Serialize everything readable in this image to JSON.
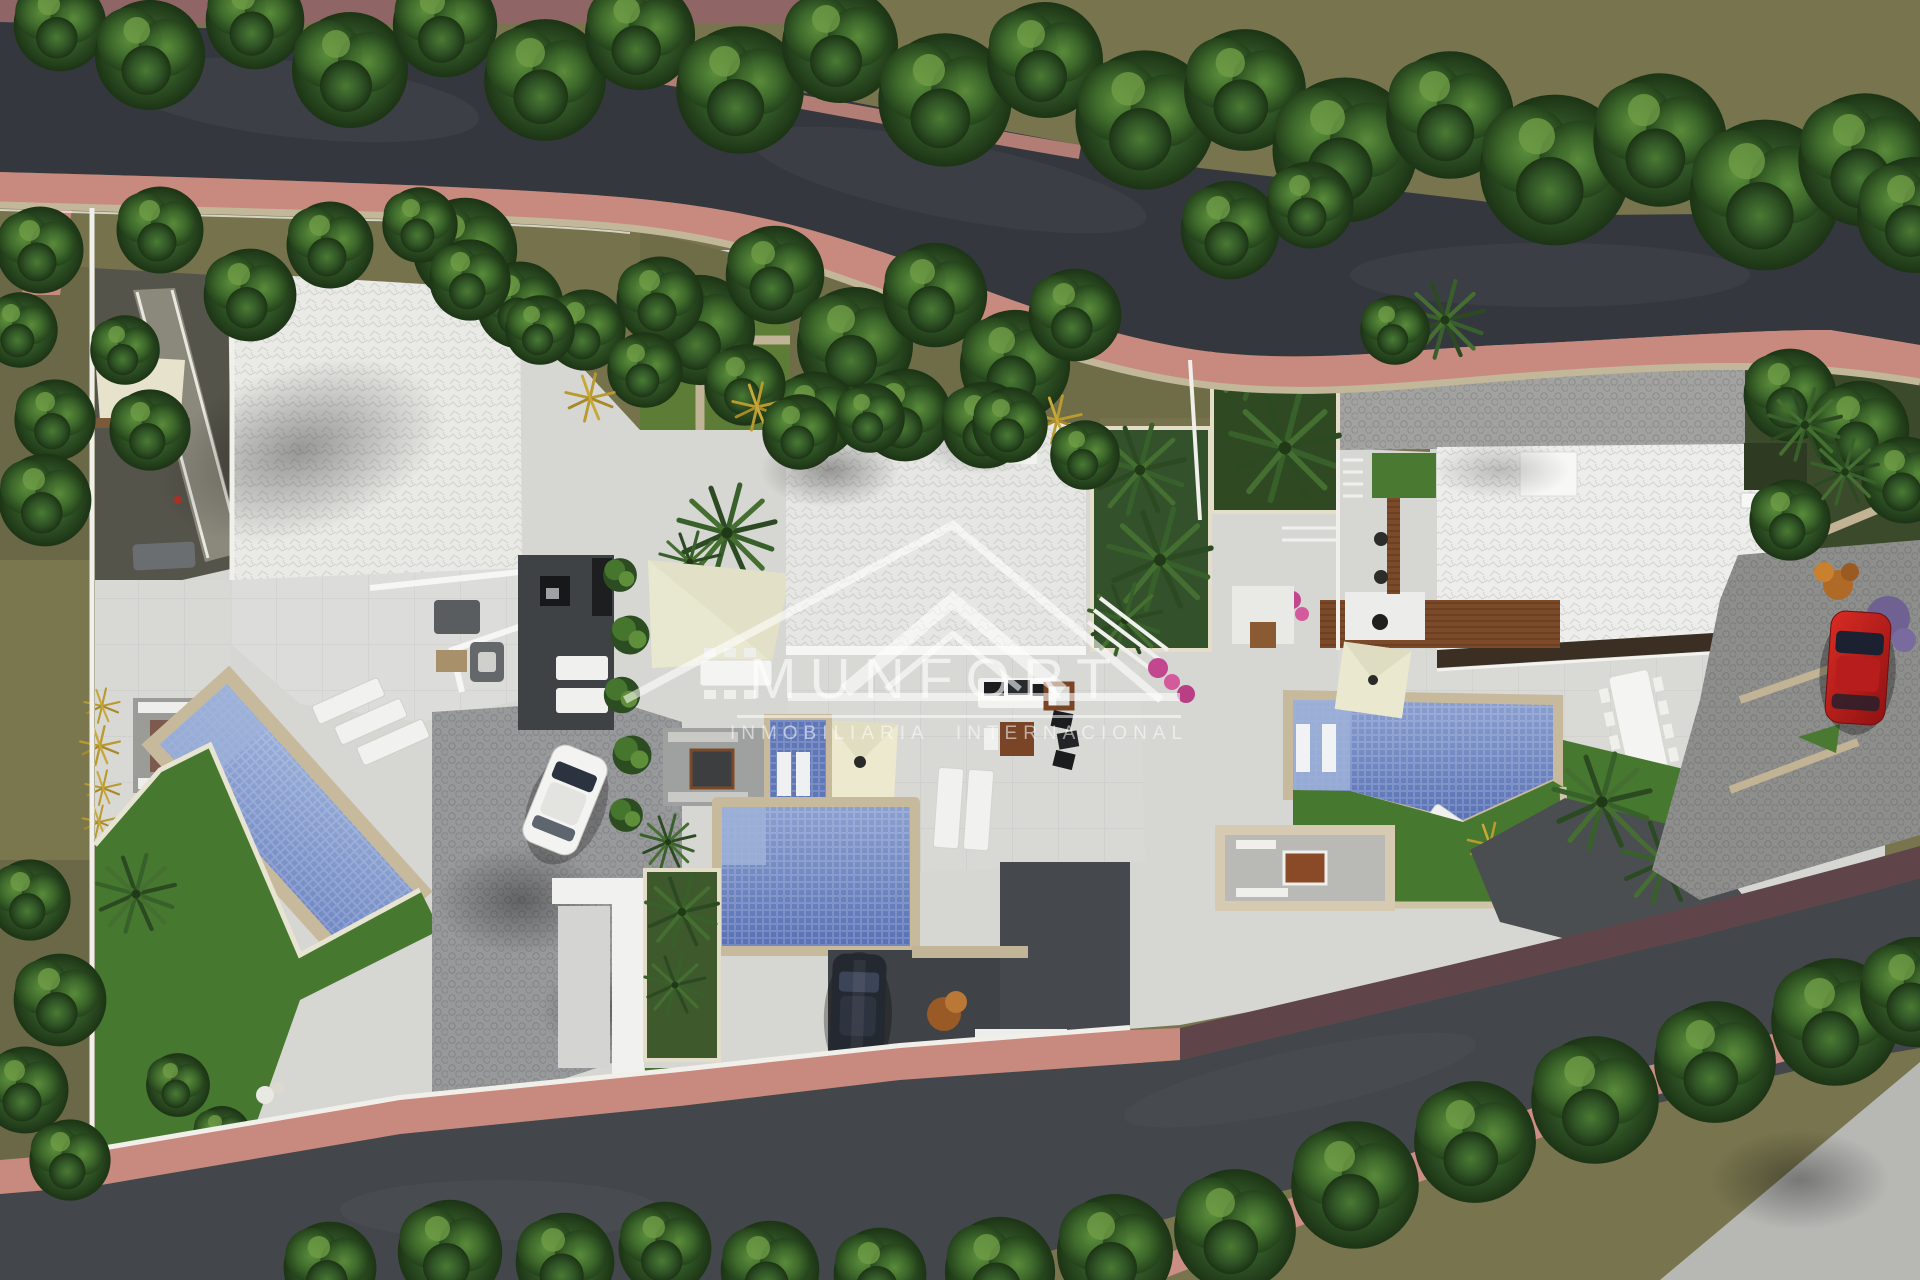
{
  "watermark": {
    "brand": "MUNFORT",
    "tagline": "INMOBILIARIA INTERNACIONAL",
    "logo_icon": "roof-triangle-icon",
    "text_color": "rgba(255,255,255,0.6)"
  },
  "palette": {
    "asphalt_top": "#34383e",
    "asphalt_bottom": "#43464a",
    "sidewalk_pink": "#c8897f",
    "sidewalk_pink_bright": "#cc8d84",
    "sidewalk_shadow_maroon": "#5f4449",
    "stone_tan": "#c3b79a",
    "slope_khaki": "#75724c",
    "lawn_green": "#47782f",
    "tree_green_dark": "#2f5323",
    "tree_green_light": "#4a7a33",
    "roof_white": "#e9eae6",
    "terrace_light": "#d8d8d5",
    "cobble_gray": "#98999b",
    "patio_charcoal": "#3f4246",
    "pool_blue": "#5871b5",
    "pool_blue_light": "#9db1d8",
    "sail_cream": "#e8e7cf",
    "wood_brown": "#7c4a28",
    "car_red": "#c22020",
    "car_white": "#f3f3f1",
    "car_dark": "#242830",
    "boundary_white": "#f0efea"
  }
}
